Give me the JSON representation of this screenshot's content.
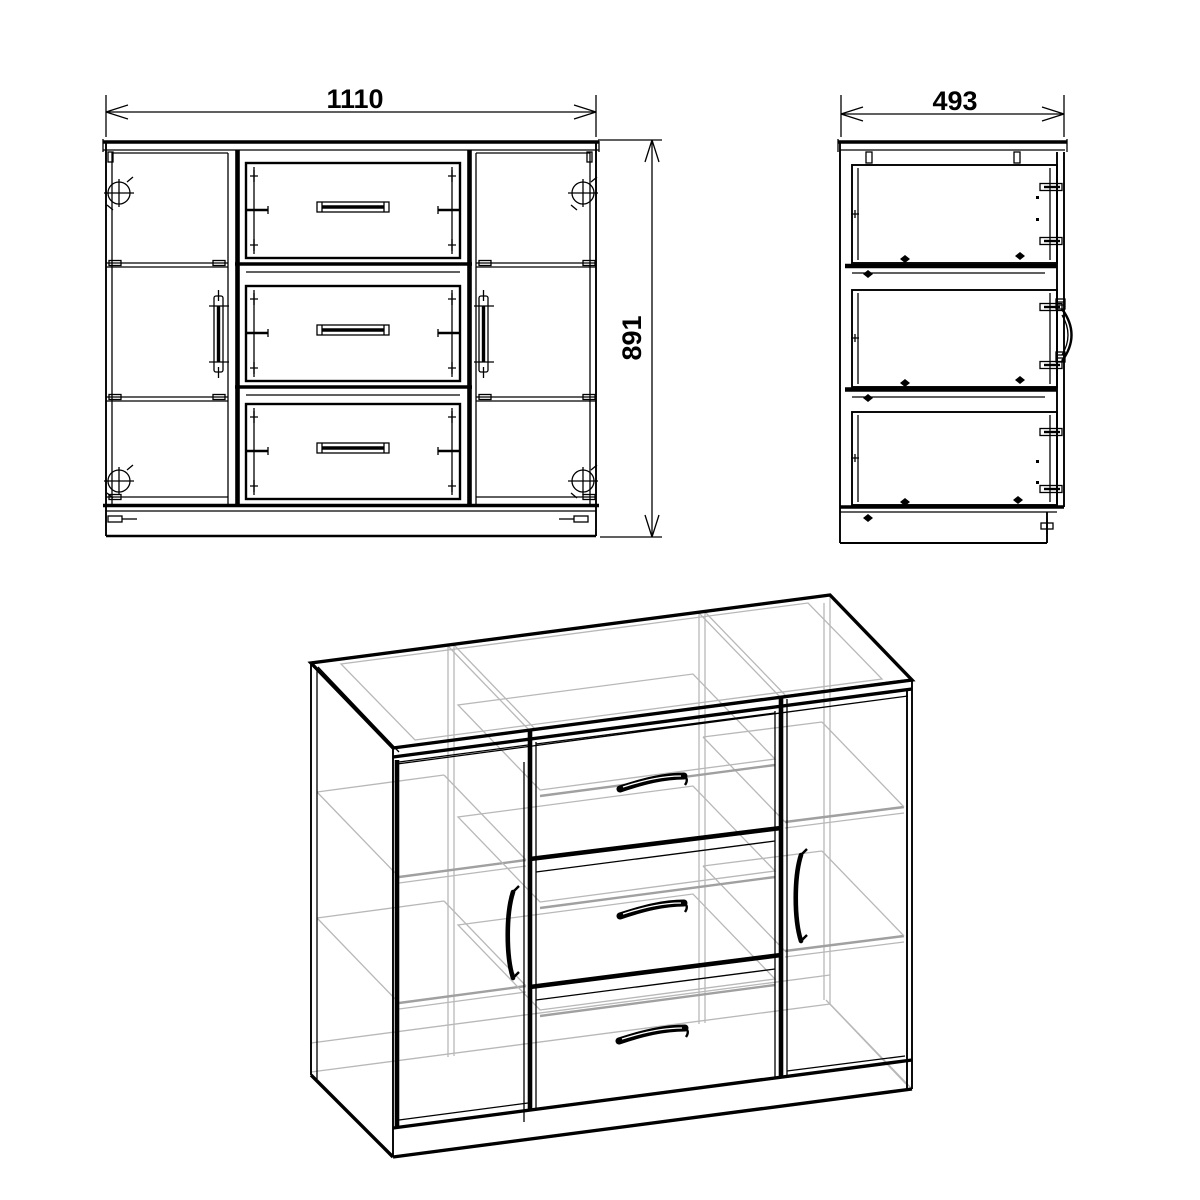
{
  "drawing": {
    "background_color": "#ffffff",
    "line_color": "#000000",
    "hidden_line_color": "#b8b8b8",
    "views": {
      "front": {
        "width_dim": "1110",
        "height_dim": "891"
      },
      "side": {
        "depth_dim": "493"
      }
    }
  }
}
